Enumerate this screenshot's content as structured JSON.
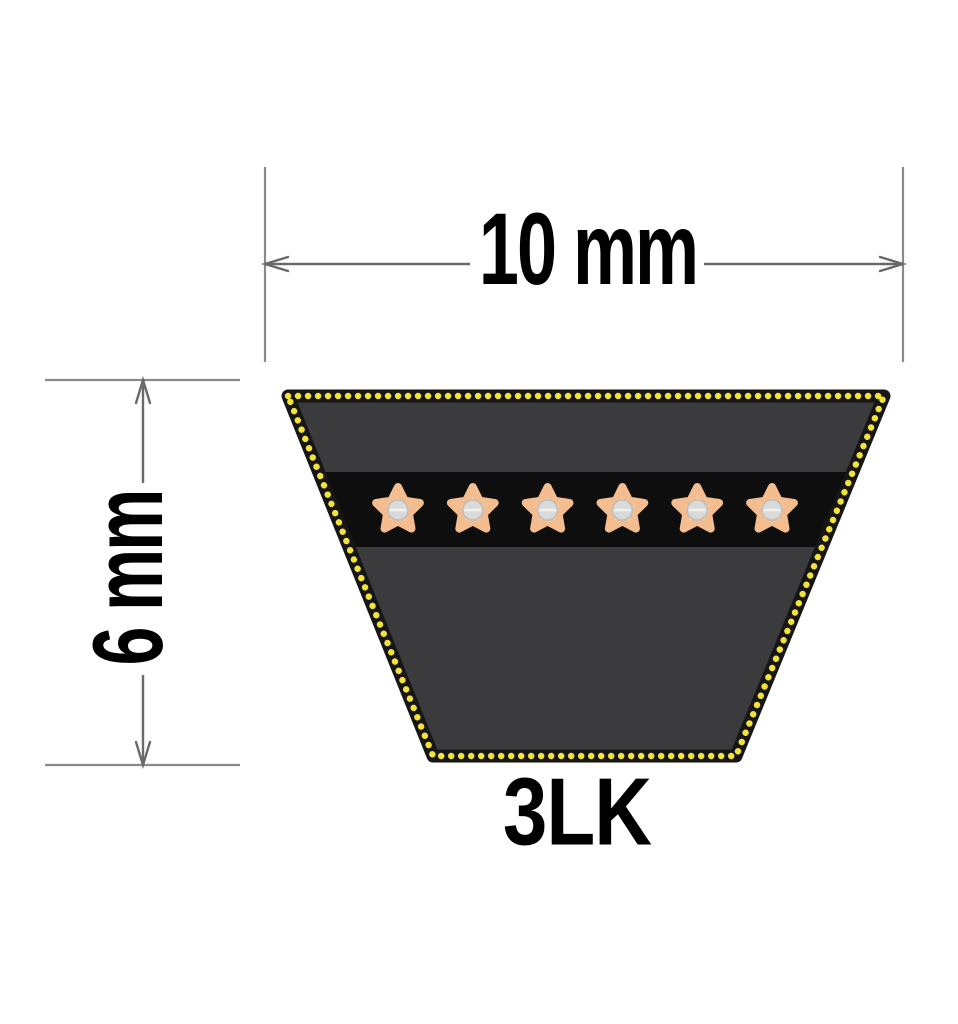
{
  "diagram": {
    "labels": {
      "width": "10 mm",
      "height": "6 mm",
      "belt_type": "3LK"
    },
    "cords": {
      "count": 6
    },
    "colors": {
      "background": "#ffffff",
      "belt_body": "#3b3b3d",
      "belt_edge": "#161616",
      "cover_dot": "#f2e23a",
      "cord_band": "#0e0e0e",
      "cord_star": "#f7c89d",
      "cord_star_edge": "#f3bd90",
      "cord_core": "#dadad8",
      "dimension_line": "#6a6a6a",
      "extension_line": "#8a8a8a",
      "label_text": "#000000"
    }
  }
}
